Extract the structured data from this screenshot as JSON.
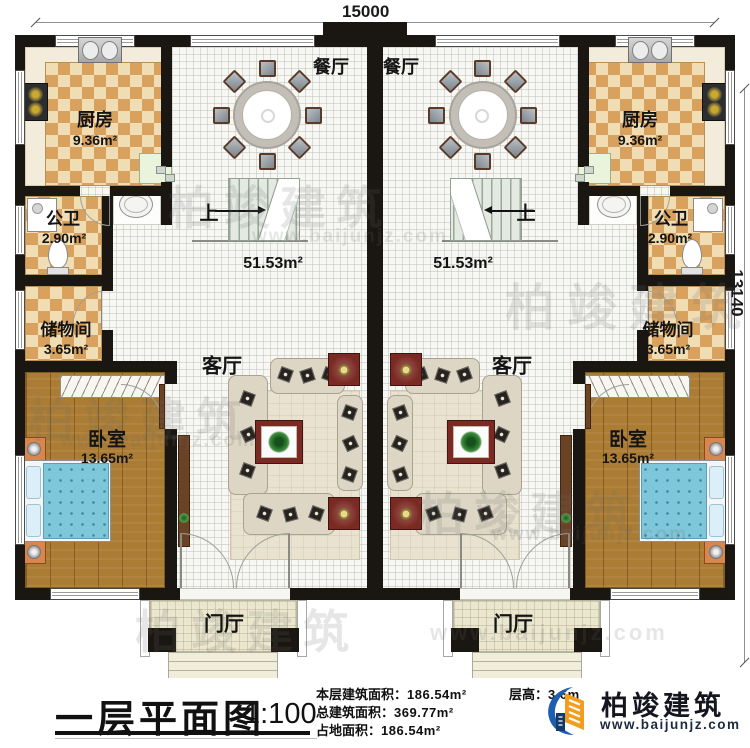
{
  "dims": {
    "width": "15000",
    "height": "13140"
  },
  "rooms": {
    "dining": "餐厅",
    "kitchen": "厨房",
    "kitchen_area": "9.36m²",
    "bath": "公卫",
    "bath_area": "2.90m²",
    "storage": "储物间",
    "storage_area": "3.65m²",
    "bedroom": "卧室",
    "bedroom_area": "13.65m²",
    "living": "客厅",
    "hall_area": "51.53m²",
    "stairs_up": "上",
    "foyer": "门厅"
  },
  "watermark": {
    "brand": "柏竣建筑",
    "site": "www.baijunjz.com"
  },
  "footer": {
    "title": "一层平面图",
    "scale": "1:100",
    "stats": [
      {
        "label": "本层建筑面积：",
        "value": "186.54m²"
      },
      {
        "label": "总建筑面积：",
        "value": "369.77m²"
      },
      {
        "label": "占地面积：",
        "value": "186.54m²"
      }
    ],
    "floor_height_label": "层高：",
    "floor_height_value": "3.6m",
    "logo_brand": "柏竣建筑",
    "logo_site": "www.baijunjz.com"
  },
  "colors": {
    "wall": "#1a1612",
    "checker_dark": "#d8a25e",
    "checker_light": "#f1ddb4",
    "wood": "#ab7c33",
    "bed": "#7ec6d9",
    "porch": "#ebe7cf",
    "furniture_red": "#7a2a22",
    "logo_blue": "#1d5fae",
    "logo_orange": "#f49c1e"
  }
}
